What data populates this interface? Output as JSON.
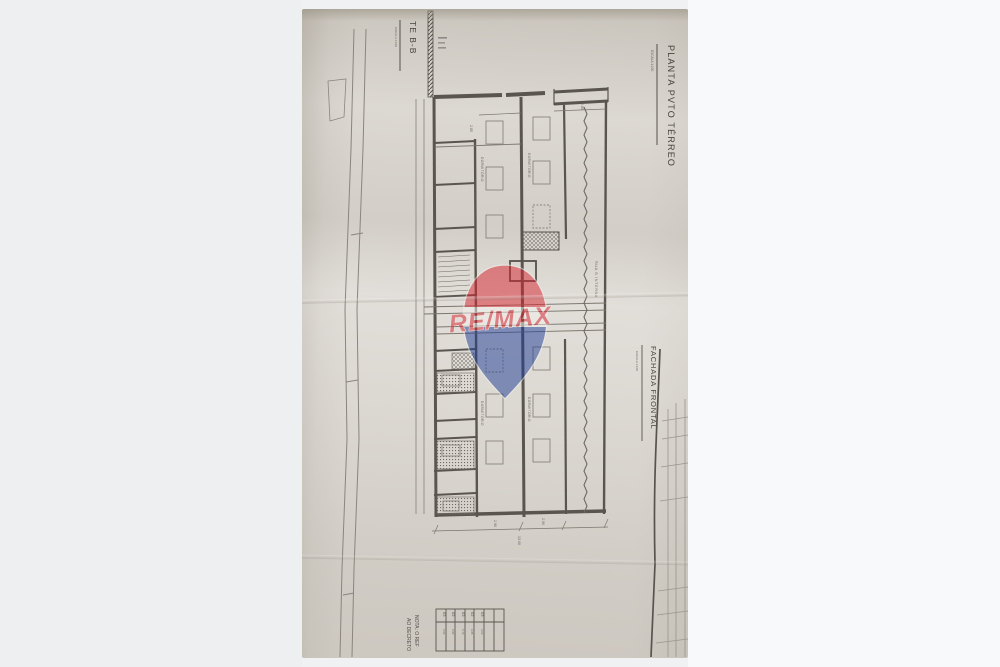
{
  "background": {
    "left_color": "#edeff1",
    "right_color": "#f8f9fb"
  },
  "photo": {
    "paper_color": "#dcd8d2",
    "ink_color": "#55524c",
    "labels": {
      "section_title": "TE B-B",
      "section_scale": "ESCALA 1:100",
      "plan_title": "PLANTA PVTO TÉRREO",
      "plan_scale": "ESCALA 1:100",
      "facade_title": "FACHADA FRONTAL",
      "facade_scale": "ESCALA 1:100",
      "note_line1": "NOTA: O REF",
      "note_line2": "AO DECRETO",
      "street_label": "RUA B INTERNA"
    },
    "rooms": [
      "DORMITÓRIO",
      "DORMITÓRIO",
      "DORMITÓRIO",
      "DORMITÓRIO"
    ],
    "dimensions": {
      "d1": "2.85",
      "d2": "2.85",
      "d3": "2.90",
      "d4": "2.90",
      "total": "13.00"
    },
    "table": {
      "headers": [
        "03",
        "02",
        "03",
        "02",
        "03"
      ],
      "values": [
        "0.90",
        "0.80",
        "0.76",
        "0.85",
        "3.06"
      ]
    }
  },
  "watermark": {
    "brand": "RE/MAX",
    "red": "#DC1C2E",
    "blue": "#003DA5"
  }
}
